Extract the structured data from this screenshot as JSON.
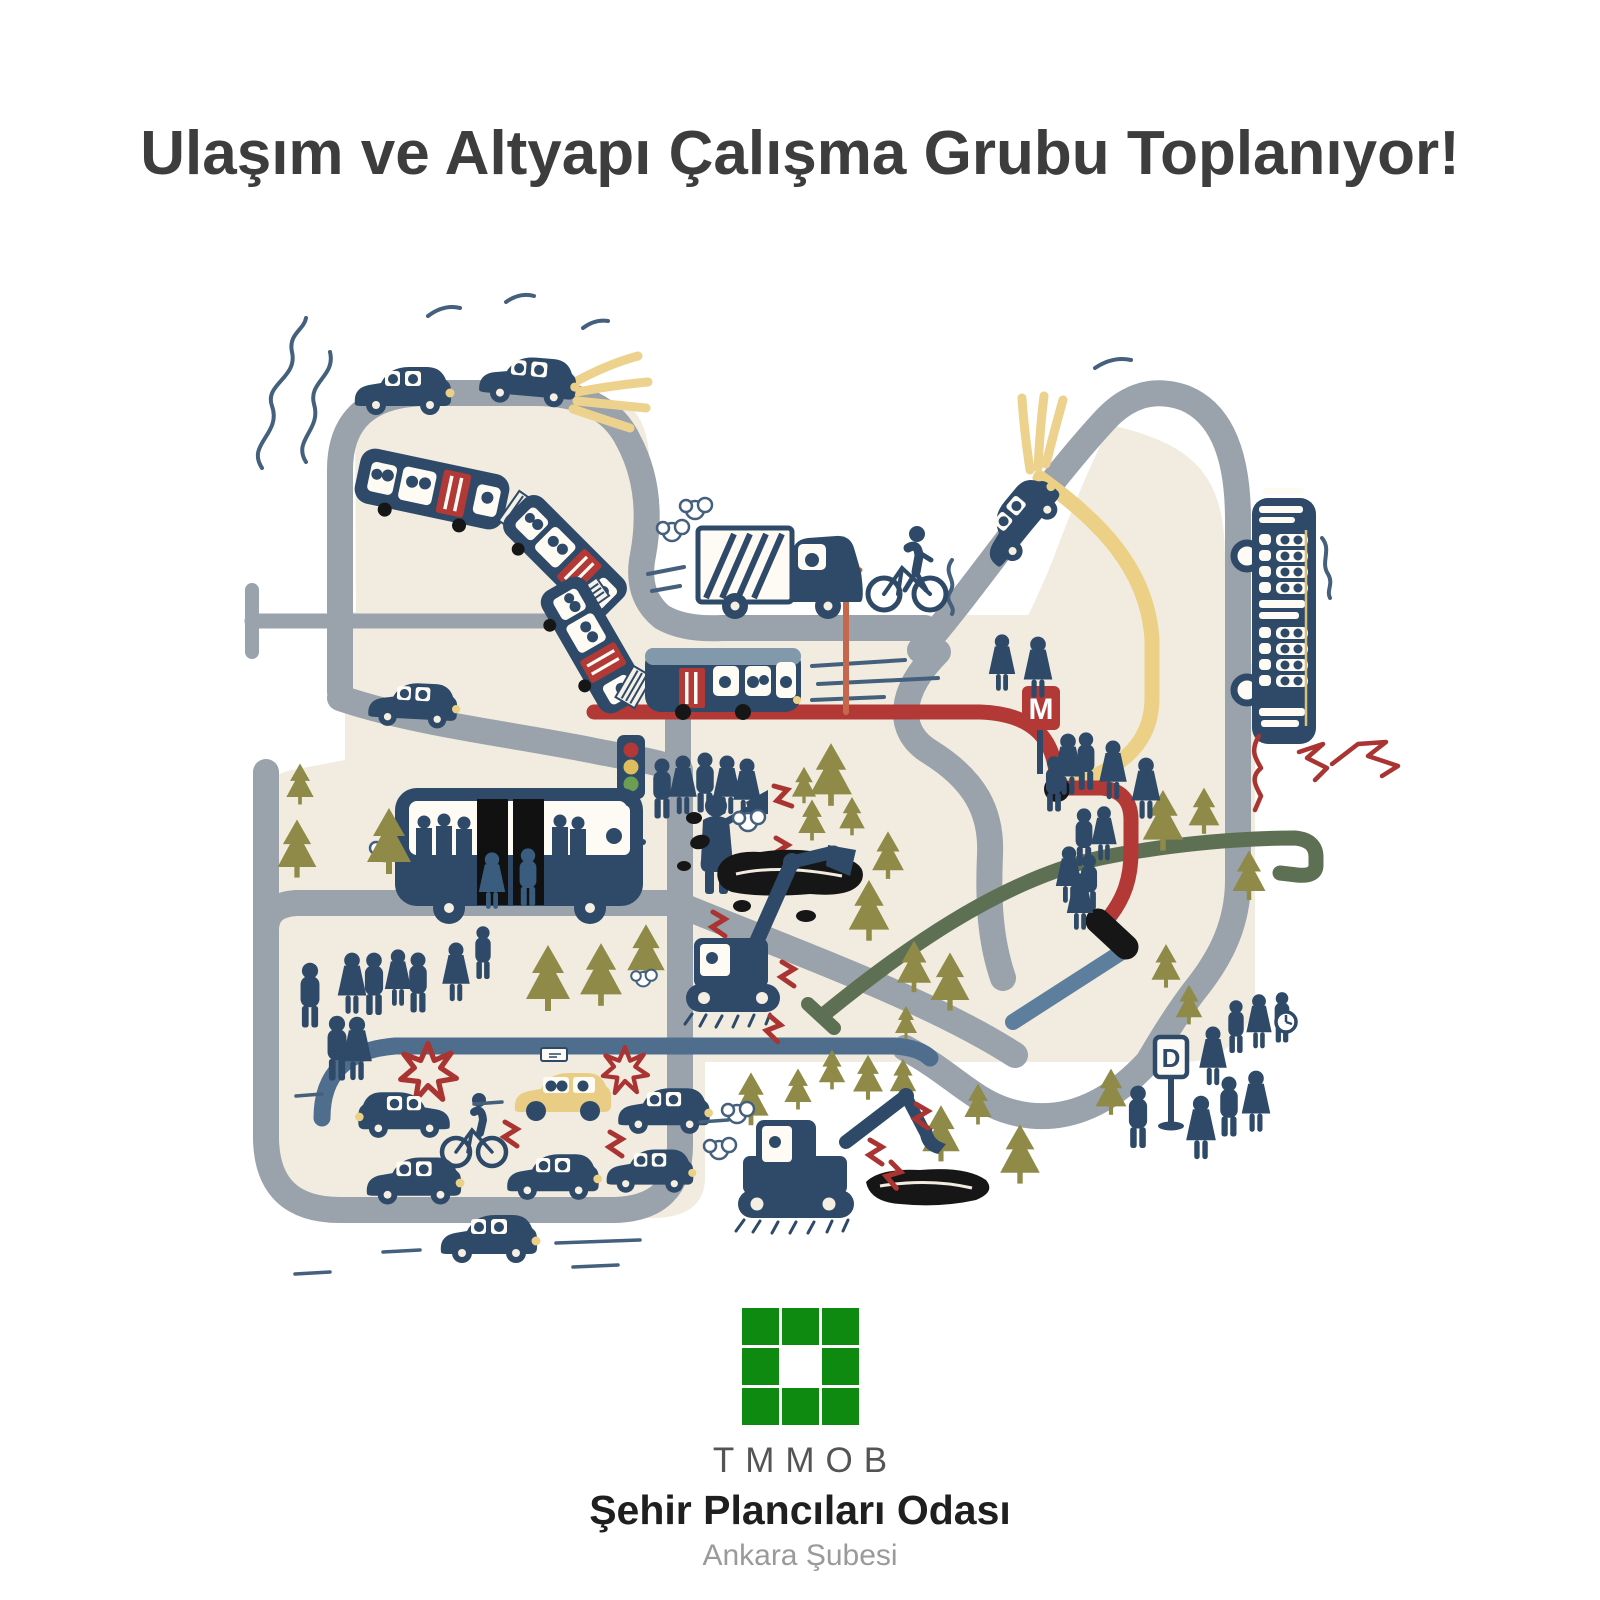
{
  "poster": {
    "title": "Ulaşım ve Altyapı Çalışma Grubu Toplanıyor!",
    "footer": {
      "org_acronym": "TMMOB",
      "org_name": "Şehir Plancıları Odası",
      "branch": "Ankara Şubesi",
      "logo": "green 3x3 square grid with white center"
    },
    "signs": {
      "metro_letter": "M",
      "stop_letter": "D"
    },
    "colors": {
      "title_text": "#3d3d3d",
      "logo_green": "#0f8a10",
      "land_beige": "#f1ecdf",
      "road_gray": "#9aa2ac",
      "vehicle_navy": "#2e4a68",
      "metro_line_red": "#b23936",
      "tram_line_yellow": "#ecd086",
      "rail_line_green": "#5d7054",
      "new_line_steel_blue": "#5d7f9d",
      "street_blue": "#4f6e8e",
      "tree_olive": "#8f8a47",
      "asphalt_black": "#161616",
      "catenary_orange": "#c4674c"
    },
    "illustration": {
      "style": "hand-drawn city transport and infrastructure map",
      "transit_lines": [
        {
          "name": "metro-line",
          "color": "#b23936",
          "note": "ends in under-construction black segment"
        },
        {
          "name": "tram-line",
          "color": "#ecd086"
        },
        {
          "name": "rail-line",
          "color": "#5d7054",
          "note": "hook-shaped end"
        },
        {
          "name": "line-under-construction",
          "color": "#5d7f9d"
        },
        {
          "name": "city-street",
          "color": "#4f6e8e"
        }
      ],
      "vehicles": [
        "metro-train-4-cars-diagonal",
        "tram-front-car",
        "crowded-city-bus",
        "articulated-bus-top-view",
        "dump-truck",
        "taxi",
        "ascending-car-with-headlight-beam",
        "passenger-cars-x9",
        "bicycles-x2",
        "excavator-digging-asphalt",
        "excavator-digging-hole"
      ],
      "signs": [
        "metro-sign-M",
        "dolmus-stop-sign-D",
        "traffic-light",
        "clock-doodle"
      ],
      "scenery": [
        "pine-trees-x27",
        "waiting-crowds",
        "megaphone-announcer",
        "asphalt-holes-x2",
        "red-crash-stars",
        "red-spark-zigzags",
        "red-cracks",
        "headlight-beams-yellow",
        "exhaust-smoke-squiggles",
        "speed-dashes"
      ]
    }
  }
}
